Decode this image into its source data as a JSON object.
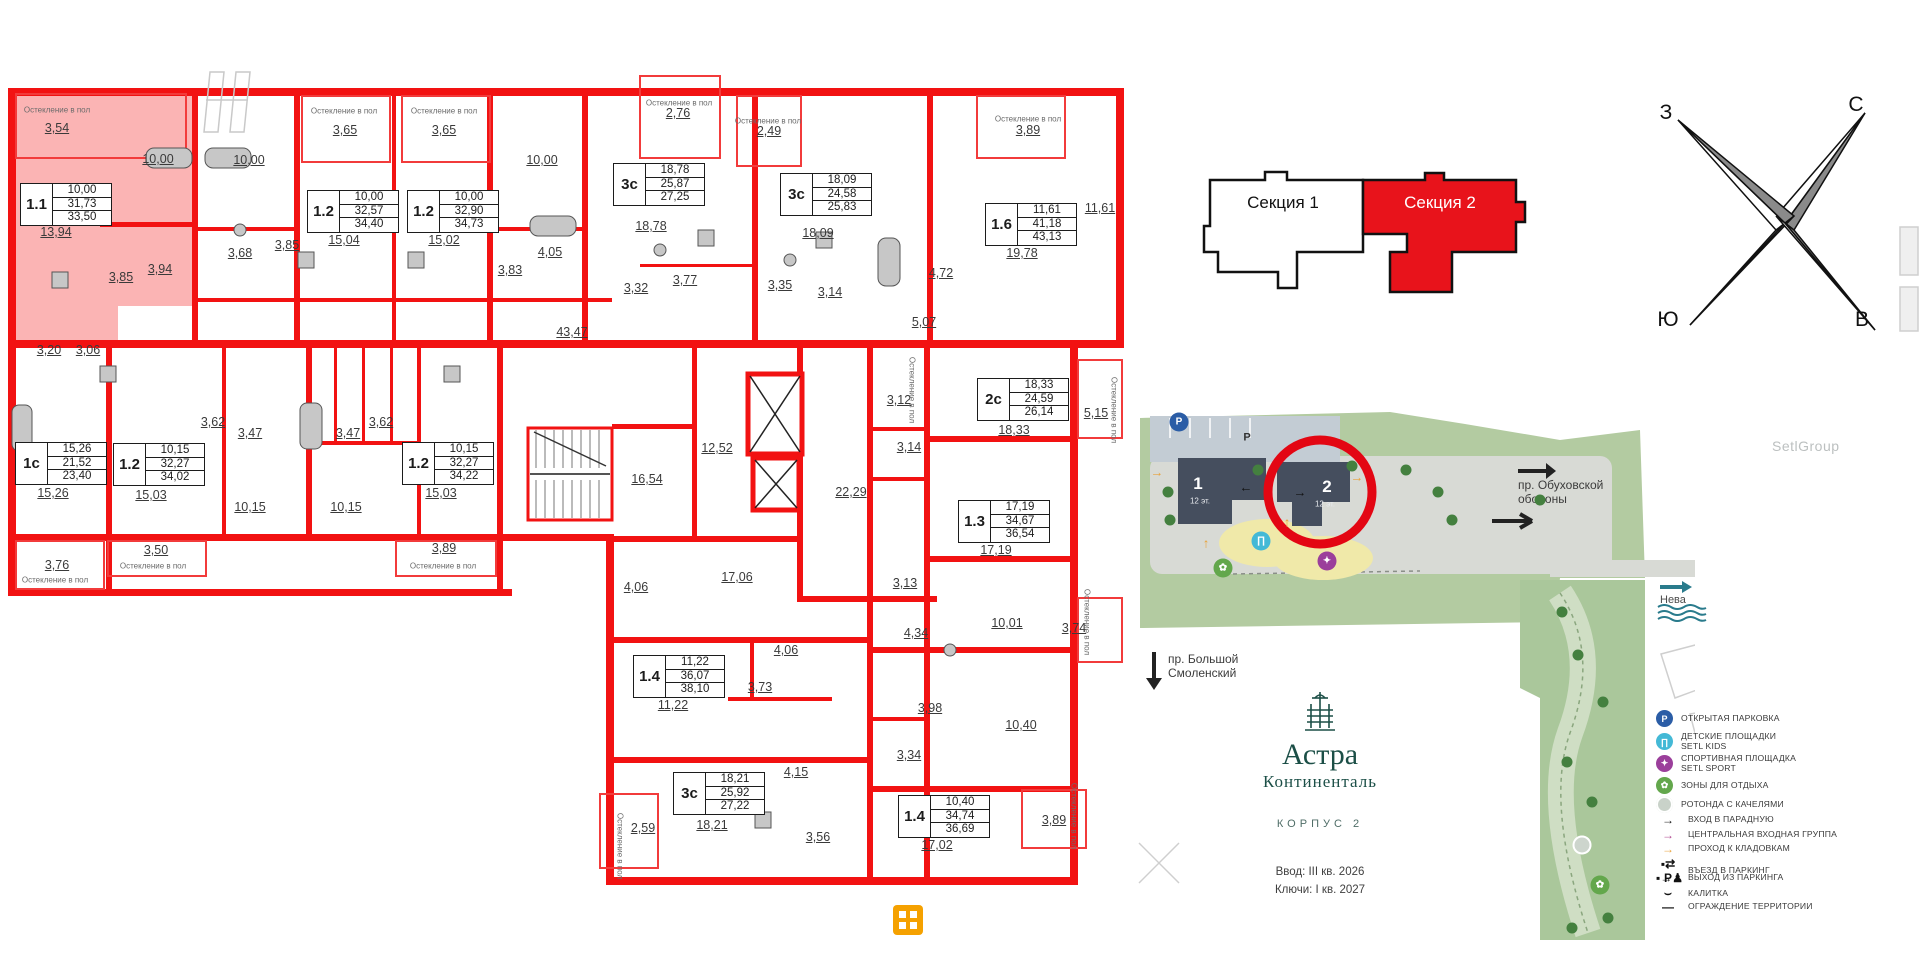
{
  "floorplan": {
    "glazing_note": "Остекление в пол",
    "tables": [
      {
        "type": "1.1",
        "values": [
          "10,00",
          "31,73",
          "33,50"
        ],
        "x": 20,
        "y": 183
      },
      {
        "type": "1.2",
        "values": [
          "10,00",
          "32,57",
          "34,40"
        ],
        "x": 307,
        "y": 190
      },
      {
        "type": "1.2",
        "values": [
          "10,00",
          "32,90",
          "34,73"
        ],
        "x": 407,
        "y": 190
      },
      {
        "type": "3с",
        "values": [
          "18,78",
          "25,87",
          "27,25"
        ],
        "x": 613,
        "y": 163
      },
      {
        "type": "3с",
        "values": [
          "18,09",
          "24,58",
          "25,83"
        ],
        "x": 780,
        "y": 173
      },
      {
        "type": "1.6",
        "values": [
          "11,61",
          "41,18",
          "43,13"
        ],
        "x": 985,
        "y": 203
      },
      {
        "type": "1с",
        "values": [
          "15,26",
          "21,52",
          "23,40"
        ],
        "x": 15,
        "y": 442
      },
      {
        "type": "1.2",
        "values": [
          "10,15",
          "32,27",
          "34,02"
        ],
        "x": 113,
        "y": 443
      },
      {
        "type": "1.2",
        "values": [
          "10,15",
          "32,27",
          "34,22"
        ],
        "x": 402,
        "y": 442
      },
      {
        "type": "2с",
        "values": [
          "18,33",
          "24,59",
          "26,14"
        ],
        "x": 977,
        "y": 378
      },
      {
        "type": "1.3",
        "values": [
          "17,19",
          "34,67",
          "36,54"
        ],
        "x": 958,
        "y": 500
      },
      {
        "type": "1.4",
        "values": [
          "11,22",
          "36,07",
          "38,10"
        ],
        "x": 633,
        "y": 655
      },
      {
        "type": "3с",
        "values": [
          "18,21",
          "25,92",
          "27,22"
        ],
        "x": 673,
        "y": 772
      },
      {
        "type": "1.4",
        "values": [
          "10,40",
          "34,74",
          "36,69"
        ],
        "x": 898,
        "y": 795
      }
    ],
    "room_labels": [
      {
        "t": "3,54",
        "x": 57,
        "y": 128
      },
      {
        "t": "10,00",
        "x": 158,
        "y": 159
      },
      {
        "t": "10,00",
        "x": 249,
        "y": 160
      },
      {
        "t": "13,94",
        "x": 56,
        "y": 232
      },
      {
        "t": "3,85",
        "x": 121,
        "y": 277
      },
      {
        "t": "3,94",
        "x": 160,
        "y": 269
      },
      {
        "t": "3,68",
        "x": 240,
        "y": 253
      },
      {
        "t": "3,85",
        "x": 287,
        "y": 245
      },
      {
        "t": "3,65",
        "x": 345,
        "y": 130
      },
      {
        "t": "15,04",
        "x": 344,
        "y": 240
      },
      {
        "t": "3,65",
        "x": 444,
        "y": 130
      },
      {
        "t": "15,02",
        "x": 444,
        "y": 240
      },
      {
        "t": "10,00",
        "x": 542,
        "y": 160
      },
      {
        "t": "3,83",
        "x": 510,
        "y": 270
      },
      {
        "t": "4,05",
        "x": 550,
        "y": 252
      },
      {
        "t": "2,76",
        "x": 678,
        "y": 113
      },
      {
        "t": "18,78",
        "x": 651,
        "y": 226
      },
      {
        "t": "3,32",
        "x": 636,
        "y": 288
      },
      {
        "t": "3,77",
        "x": 685,
        "y": 280
      },
      {
        "t": "2,49",
        "x": 769,
        "y": 131
      },
      {
        "t": "18,09",
        "x": 818,
        "y": 233
      },
      {
        "t": "3,35",
        "x": 780,
        "y": 285
      },
      {
        "t": "3,14",
        "x": 830,
        "y": 292
      },
      {
        "t": "3,89",
        "x": 1028,
        "y": 130
      },
      {
        "t": "11,61",
        "x": 1100,
        "y": 208
      },
      {
        "t": "19,78",
        "x": 1022,
        "y": 253
      },
      {
        "t": "4,72",
        "x": 941,
        "y": 273
      },
      {
        "t": "5,07",
        "x": 924,
        "y": 322
      },
      {
        "t": "43,47",
        "x": 572,
        "y": 332
      },
      {
        "t": "3,20",
        "x": 49,
        "y": 350
      },
      {
        "t": "3,06",
        "x": 88,
        "y": 350
      },
      {
        "t": "15,26",
        "x": 53,
        "y": 493
      },
      {
        "t": "3,76",
        "x": 57,
        "y": 565
      },
      {
        "t": "15,03",
        "x": 151,
        "y": 495
      },
      {
        "t": "3,50",
        "x": 156,
        "y": 550
      },
      {
        "t": "3,62",
        "x": 213,
        "y": 422
      },
      {
        "t": "3,47",
        "x": 250,
        "y": 433
      },
      {
        "t": "10,15",
        "x": 250,
        "y": 507
      },
      {
        "t": "3,62",
        "x": 381,
        "y": 422
      },
      {
        "t": "3,47",
        "x": 348,
        "y": 433
      },
      {
        "t": "10,15",
        "x": 346,
        "y": 507
      },
      {
        "t": "15,03",
        "x": 441,
        "y": 493
      },
      {
        "t": "3,89",
        "x": 444,
        "y": 548
      },
      {
        "t": "16,54",
        "x": 647,
        "y": 479
      },
      {
        "t": "12,52",
        "x": 717,
        "y": 448
      },
      {
        "t": "22,29",
        "x": 851,
        "y": 492
      },
      {
        "t": "17,06",
        "x": 737,
        "y": 577
      },
      {
        "t": "4,06",
        "x": 636,
        "y": 587
      },
      {
        "t": "3,12",
        "x": 899,
        "y": 400
      },
      {
        "t": "3,14",
        "x": 909,
        "y": 447
      },
      {
        "t": "18,33",
        "x": 1014,
        "y": 430
      },
      {
        "t": "5,15",
        "x": 1096,
        "y": 413
      },
      {
        "t": "17,19",
        "x": 996,
        "y": 550
      },
      {
        "t": "3,13",
        "x": 905,
        "y": 583
      },
      {
        "t": "11,22",
        "x": 673,
        "y": 705
      },
      {
        "t": "3,73",
        "x": 760,
        "y": 687
      },
      {
        "t": "4,06",
        "x": 786,
        "y": 650
      },
      {
        "t": "18,21",
        "x": 712,
        "y": 825
      },
      {
        "t": "4,15",
        "x": 796,
        "y": 772
      },
      {
        "t": "3,56",
        "x": 818,
        "y": 837
      },
      {
        "t": "2,59",
        "x": 643,
        "y": 828
      },
      {
        "t": "4,34",
        "x": 916,
        "y": 633
      },
      {
        "t": "10,01",
        "x": 1007,
        "y": 623
      },
      {
        "t": "3,74",
        "x": 1074,
        "y": 628
      },
      {
        "t": "3,98",
        "x": 930,
        "y": 708
      },
      {
        "t": "10,40",
        "x": 1021,
        "y": 725
      },
      {
        "t": "3,34",
        "x": 909,
        "y": 755
      },
      {
        "t": "17,02",
        "x": 937,
        "y": 845
      },
      {
        "t": "3,89",
        "x": 1054,
        "y": 820
      }
    ],
    "glazing_notes": [
      {
        "x": 57,
        "y": 110
      },
      {
        "x": 344,
        "y": 111
      },
      {
        "x": 444,
        "y": 111
      },
      {
        "x": 679,
        "y": 103
      },
      {
        "x": 768,
        "y": 121
      },
      {
        "x": 1028,
        "y": 119
      },
      {
        "x": 55,
        "y": 580
      },
      {
        "x": 153,
        "y": 566
      },
      {
        "x": 443,
        "y": 566
      },
      {
        "x": 1114,
        "y": 410,
        "v": 1
      },
      {
        "x": 912,
        "y": 390,
        "v": 1
      },
      {
        "x": 1087,
        "y": 622,
        "v": 1
      },
      {
        "x": 1074,
        "y": 816,
        "v": 1
      },
      {
        "x": 620,
        "y": 846,
        "v": 1
      }
    ]
  },
  "section_selector": {
    "sections": [
      {
        "label": "Секция 1",
        "selected": false
      },
      {
        "label": "Секция 2",
        "selected": true
      }
    ],
    "selected_color": "#e8131b"
  },
  "compass": {
    "north": "С",
    "south": "Ю",
    "west": "З",
    "east": "В"
  },
  "site_plan": {
    "buildings": [
      {
        "number": "1",
        "floors": "12 эт.",
        "selected": false
      },
      {
        "number": "2",
        "floors": "12 эт.",
        "selected": true
      }
    ],
    "roads": {
      "obukhov": "пр. Обуховской\nобороны",
      "smolensky": "пр. Большой\nСмоленский"
    },
    "river": "Нева",
    "parking_mark": "Р",
    "poi": [
      {
        "kind": "circle",
        "glyph": "P",
        "color": "#2b5da6",
        "x": 1179,
        "y": 422
      },
      {
        "kind": "circle",
        "glyph": "∏",
        "color": "#44b9d6",
        "x": 1261,
        "y": 541
      },
      {
        "kind": "circle",
        "glyph": "✦",
        "color": "#9b3f9b",
        "x": 1327,
        "y": 561
      },
      {
        "kind": "circle",
        "glyph": "✿",
        "color": "#63a74c",
        "x": 1223,
        "y": 568
      },
      {
        "kind": "circle",
        "glyph": "",
        "color": "#cdd5cd",
        "ring": 1,
        "x": 1582,
        "y": 845
      },
      {
        "kind": "circle",
        "glyph": "✿",
        "color": "#63a74c",
        "x": 1600,
        "y": 885
      },
      {
        "kind": "sym",
        "glyph": "→",
        "color": "#111111",
        "x": 1300,
        "y": 492
      },
      {
        "kind": "sym",
        "glyph": "←",
        "color": "#111111",
        "x": 1246,
        "y": 487
      },
      {
        "kind": "sym",
        "glyph": "→",
        "color": "#e8a33d",
        "x": 1157,
        "y": 472
      },
      {
        "kind": "sym",
        "glyph": "↑",
        "color": "#e8a33d",
        "x": 1206,
        "y": 543
      },
      {
        "kind": "sym",
        "glyph": "↑",
        "color": "#e8a33d",
        "x": 1287,
        "y": 522
      },
      {
        "kind": "sym",
        "glyph": "→",
        "color": "#e8a33d",
        "x": 1357,
        "y": 477
      },
      {
        "kind": "dot",
        "color": "#44803f",
        "x": 1168,
        "y": 492
      },
      {
        "kind": "dot",
        "color": "#44803f",
        "x": 1170,
        "y": 520
      },
      {
        "kind": "dot",
        "color": "#44803f",
        "x": 1258,
        "y": 470
      },
      {
        "kind": "dot",
        "color": "#44803f",
        "x": 1352,
        "y": 466
      },
      {
        "kind": "dot",
        "color": "#44803f",
        "x": 1406,
        "y": 470
      },
      {
        "kind": "dot",
        "color": "#44803f",
        "x": 1438,
        "y": 492
      },
      {
        "kind": "dot",
        "color": "#44803f",
        "x": 1452,
        "y": 520
      },
      {
        "kind": "dot",
        "color": "#44803f",
        "x": 1540,
        "y": 500
      },
      {
        "kind": "dot",
        "color": "#44803f",
        "x": 1562,
        "y": 612
      },
      {
        "kind": "dot",
        "color": "#44803f",
        "x": 1578,
        "y": 655
      },
      {
        "kind": "dot",
        "color": "#44803f",
        "x": 1603,
        "y": 702
      },
      {
        "kind": "dot",
        "color": "#44803f",
        "x": 1567,
        "y": 762
      },
      {
        "kind": "dot",
        "color": "#44803f",
        "x": 1592,
        "y": 802
      },
      {
        "kind": "dot",
        "color": "#44803f",
        "x": 1608,
        "y": 918
      },
      {
        "kind": "dot",
        "color": "#44803f",
        "x": 1572,
        "y": 928
      }
    ]
  },
  "legend": {
    "items": [
      {
        "kind": "circle",
        "glyph": "P",
        "color": "#2b5da6",
        "label": "ОТКРЫТАЯ ПАРКОВКА",
        "y": 719
      },
      {
        "kind": "circle",
        "glyph": "∏",
        "color": "#44b9d6",
        "label": "ДЕТСКИЕ ПЛОЩАДКИ",
        "label2": "SETL KIDS",
        "y": 741
      },
      {
        "kind": "circle",
        "glyph": "✦",
        "color": "#9b3f9b",
        "label": "СПОРТИВНАЯ ПЛОЩАДКА",
        "label2": "SETL SPORT",
        "y": 763
      },
      {
        "kind": "circle",
        "glyph": "✿",
        "color": "#63a74c",
        "label": "ЗОНЫ ДЛЯ ОТДЫХА",
        "y": 786
      },
      {
        "kind": "circle",
        "glyph": "",
        "color": "#c9d2c9",
        "ring": 1,
        "label": "РОТОНДА С КАЧЕЛЯМИ",
        "y": 805
      },
      {
        "kind": "sym",
        "glyph": "→",
        "color": "#111111",
        "label": "ВХОД В ПАРАДНУЮ",
        "y": 822
      },
      {
        "kind": "sym",
        "glyph": "→",
        "color": "#b0478f",
        "label": "ЦЕНТРАЛЬНАЯ ВХОДНАЯ ГРУППА",
        "y": 837
      },
      {
        "kind": "sym",
        "glyph": "→",
        "color": "#e8a33d",
        "label": "ПРОХОД К КЛАДОВКАМ",
        "y": 851
      },
      {
        "kind": "sym",
        "glyph": "▪⇄ P",
        "color": "#111111",
        "label": "ВЪЕЗД В ПАРКИНГ",
        "y": 866
      },
      {
        "kind": "sym",
        "glyph": "▪→♟",
        "color": "#111111",
        "label": "ВЫХОД ИЗ ПАРКИНГА",
        "y": 880
      },
      {
        "kind": "sym",
        "glyph": "⌣",
        "color": "#111111",
        "label": "КАЛИТКА",
        "y": 895
      },
      {
        "kind": "sym",
        "glyph": "—",
        "color": "#111111",
        "label": "ОГРАЖДЕНИЕ ТЕРРИТОРИИ",
        "y": 909
      }
    ]
  },
  "branding": {
    "project_line1": "Астра",
    "project_line2": "Континенталь",
    "building": "КОРПУС 2",
    "commissioning": "Ввод: III кв. 2026",
    "keys": "Ключи: I кв. 2027",
    "watermark": "SetlGroup"
  }
}
